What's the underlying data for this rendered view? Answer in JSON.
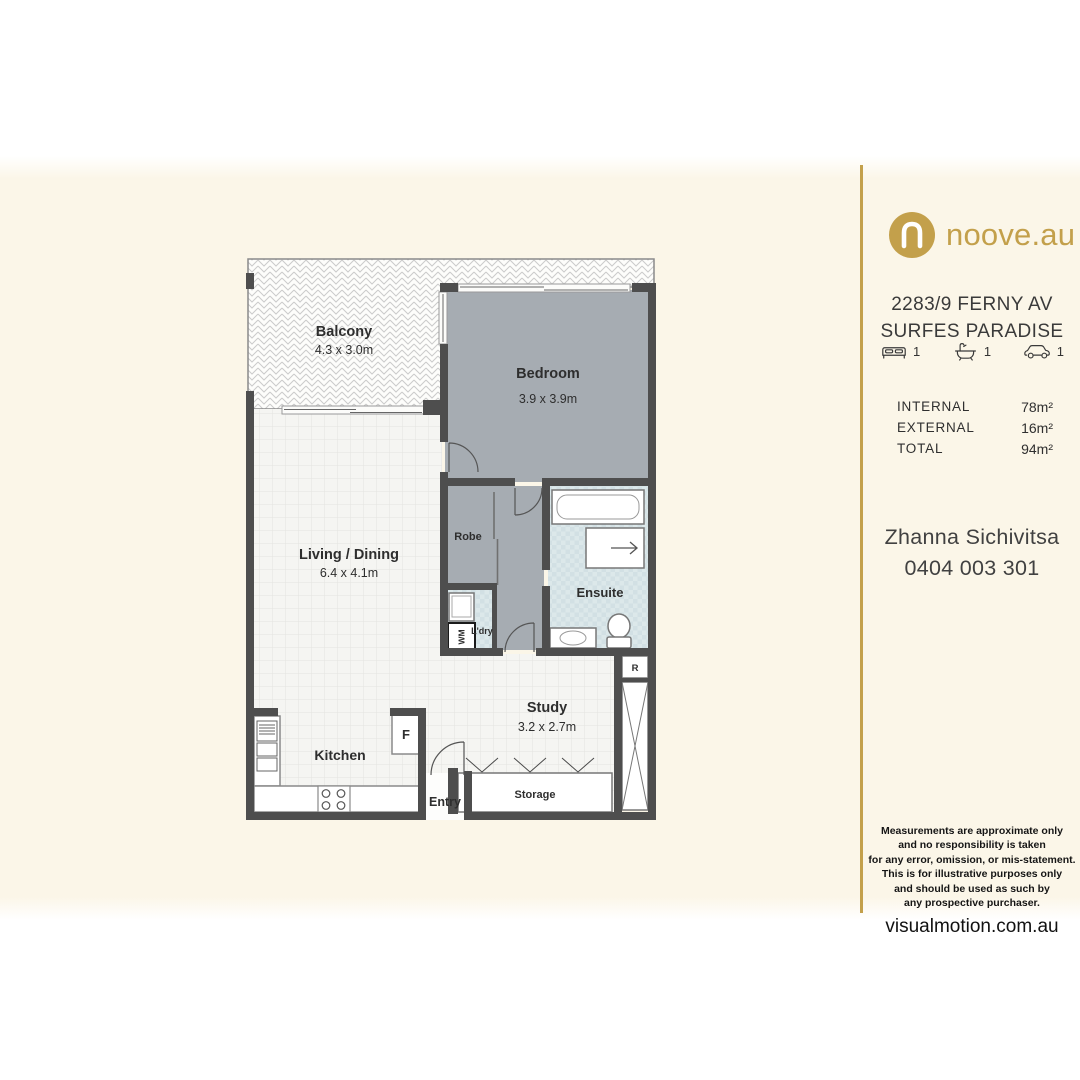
{
  "brand": {
    "logo_text": "noove.au",
    "gold": "#C3A04B"
  },
  "listing": {
    "address_line1": "2283/9 FERNY AV",
    "address_line2": "SURFES PARADISE",
    "features": [
      {
        "icon": "bed-icon",
        "count": "1"
      },
      {
        "icon": "bath-icon",
        "count": "1"
      },
      {
        "icon": "car-icon",
        "count": "1"
      }
    ],
    "areas": [
      {
        "label": "INTERNAL",
        "value": "78m²"
      },
      {
        "label": "EXTERNAL",
        "value": "16m²"
      },
      {
        "label": "TOTAL",
        "value": "94m²"
      }
    ]
  },
  "agent": {
    "name": "Zhanna Sichivitsa",
    "phone": "0404 003 301"
  },
  "disclaimer": {
    "lines": [
      "Measurements are approximate only",
      "and no responsibility is taken",
      "for any error, omission, or mis-statement.",
      "This is for illustrative purposes only",
      "and should be used as such by",
      "any prospective purchaser."
    ],
    "website": "visualmotion.com.au"
  },
  "floorplan": {
    "rooms": {
      "balcony": {
        "name": "Balcony",
        "dims": "4.3 x 3.0m"
      },
      "bedroom": {
        "name": "Bedroom",
        "dims": "3.9 x 3.9m"
      },
      "living": {
        "name": "Living / Dining",
        "dims": "6.4 x 4.1m"
      },
      "robe": {
        "name": "Robe"
      },
      "ensuite": {
        "name": "Ensuite"
      },
      "laundry": {
        "name": "L'dry"
      },
      "kitchen": {
        "name": "Kitchen"
      },
      "entry": {
        "name": "Entry"
      },
      "study": {
        "name": "Study",
        "dims": "3.2 x 2.7m"
      },
      "storage": {
        "name": "Storage"
      }
    },
    "markers": {
      "washing_machine": "WM",
      "fridge": "F",
      "riser": "R"
    }
  }
}
